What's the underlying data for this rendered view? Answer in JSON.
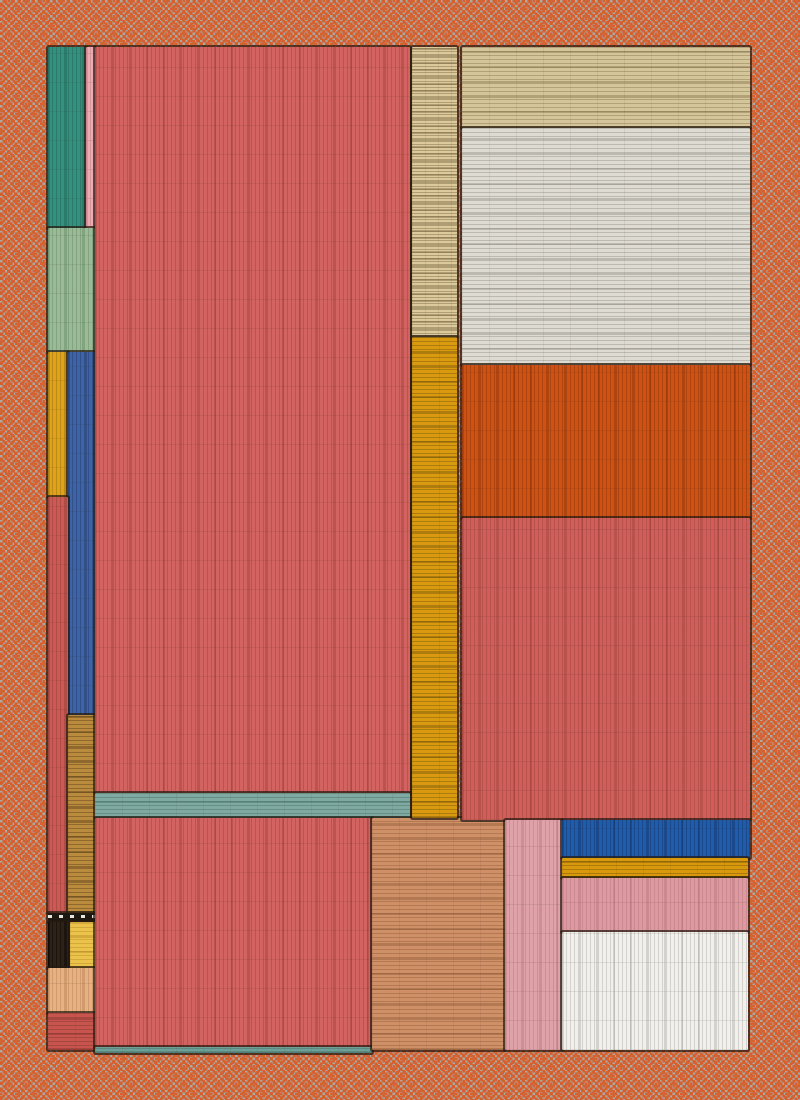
{
  "artwork": {
    "title": "abstract-hatched-color-field",
    "canvas": {
      "width": 800,
      "height": 1100
    },
    "background": {
      "pattern": "dither-checker",
      "colors": [
        "#d95f2b",
        "#a9a9a5"
      ]
    },
    "stroke_color": "#261b11",
    "pieces": [
      {
        "name": "teal-block-top-left",
        "x": 48,
        "y": 47,
        "w": 38,
        "h": 181,
        "color": "#35917f",
        "line": "#1c5a4e66",
        "hatch": "v"
      },
      {
        "name": "pink-sliver-top-left",
        "x": 86,
        "y": 47,
        "w": 9,
        "h": 181,
        "color": "#ecaab1",
        "line": "#b06a7455",
        "hatch": "v"
      },
      {
        "name": "sage-block-left",
        "x": 48,
        "y": 228,
        "w": 47,
        "h": 124,
        "color": "#9cba98",
        "line": "#4c7a4c55",
        "hatch": "v"
      },
      {
        "name": "gold-sliver-left",
        "x": 48,
        "y": 352,
        "w": 20,
        "h": 145,
        "color": "#dfa31a",
        "line": "#8a640e66",
        "hatch": "v"
      },
      {
        "name": "blue-sliver-left",
        "x": 68,
        "y": 352,
        "w": 27,
        "h": 363,
        "color": "#3e63a6",
        "line": "#1e355e66",
        "hatch": "v"
      },
      {
        "name": "red-sliver-left",
        "x": 48,
        "y": 497,
        "w": 20,
        "h": 416,
        "color": "#cc5a54",
        "line": "#7a2f2a55",
        "hatch": "v"
      },
      {
        "name": "brown-sliver-left",
        "x": 68,
        "y": 715,
        "w": 27,
        "h": 198,
        "color": "#bb8b3d",
        "line": "#5a401877",
        "hatch": "h"
      },
      {
        "name": "black-band-left",
        "x": 48,
        "y": 913,
        "w": 47,
        "h": 9,
        "color": "#1e1812",
        "line": "#e8e6df88",
        "hatch": "dashes"
      },
      {
        "name": "dark-brown-block-left",
        "x": 48,
        "y": 922,
        "w": 22,
        "h": 46,
        "color": "#2e2217",
        "line": "#00000066",
        "hatch": "v"
      },
      {
        "name": "yellow-block-left",
        "x": 70,
        "y": 922,
        "w": 25,
        "h": 46,
        "color": "#ecc34a",
        "line": "#a3762055",
        "hatch": "h"
      },
      {
        "name": "peach-block-left",
        "x": 48,
        "y": 968,
        "w": 47,
        "h": 45,
        "color": "#e7b184",
        "line": "#a5703f55",
        "hatch": "v"
      },
      {
        "name": "red-block-bottom-left",
        "x": 48,
        "y": 1013,
        "w": 47,
        "h": 37,
        "color": "#c7554e",
        "line": "#7a2f2a66",
        "hatch": "h"
      },
      {
        "name": "main-red-block",
        "x": 95,
        "y": 47,
        "w": 315,
        "h": 746,
        "color": "#d26360",
        "line": "#8c363055",
        "hatch": "v"
      },
      {
        "name": "teal-strip-middle",
        "x": 95,
        "y": 793,
        "w": 315,
        "h": 25,
        "color": "#80a9a1",
        "line": "#3d6a6266",
        "hatch": "h"
      },
      {
        "name": "bottom-red-block",
        "x": 95,
        "y": 818,
        "w": 277,
        "h": 229,
        "color": "#d26360",
        "line": "#8c363055",
        "hatch": "v"
      },
      {
        "name": "bottom-teal-line",
        "x": 95,
        "y": 1047,
        "w": 277,
        "h": 6,
        "color": "#6fa097",
        "line": "#3d6a6266",
        "hatch": "h"
      },
      {
        "name": "bottom-tan-block",
        "x": 372,
        "y": 818,
        "w": 133,
        "h": 232,
        "color": "#cf9068",
        "line": "#7a4a2855",
        "hatch": "h"
      },
      {
        "name": "tan-strip-top-middle",
        "x": 412,
        "y": 47,
        "w": 45,
        "h": 290,
        "color": "#dcca9d",
        "line": "#6b5a3466",
        "hatch": "rough"
      },
      {
        "name": "gold-strip-middle",
        "x": 412,
        "y": 337,
        "w": 45,
        "h": 481,
        "color": "#d99a10",
        "line": "#6b4c0a66",
        "hatch": "h"
      },
      {
        "name": "beige-band-top-right",
        "x": 462,
        "y": 47,
        "w": 288,
        "h": 81,
        "color": "#d5c59a",
        "line": "#6b5a3455",
        "hatch": "h"
      },
      {
        "name": "white-region-top-right",
        "x": 462,
        "y": 128,
        "w": 288,
        "h": 237,
        "color": "#dedbd3",
        "line": "#8a867e66",
        "hatch": "h"
      },
      {
        "name": "orange-region-right",
        "x": 462,
        "y": 365,
        "w": 288,
        "h": 153,
        "color": "#d05212",
        "line": "#7c300d66",
        "hatch": "v"
      },
      {
        "name": "right-red-block",
        "x": 462,
        "y": 518,
        "w": 288,
        "h": 302,
        "color": "#d05f5c",
        "line": "#8c363055",
        "hatch": "v"
      },
      {
        "name": "pink-column-bottom",
        "x": 505,
        "y": 820,
        "w": 57,
        "h": 230,
        "color": "#e0a2a9",
        "line": "#a8666f55",
        "hatch": "v"
      },
      {
        "name": "blue-band-bottom-right",
        "x": 562,
        "y": 820,
        "w": 188,
        "h": 38,
        "color": "#1f5cab",
        "line": "#122f5c66",
        "hatch": "v"
      },
      {
        "name": "gold-band-bottom-right",
        "x": 562,
        "y": 858,
        "w": 186,
        "h": 20,
        "color": "#d9990c",
        "line": "#6b4c0a66",
        "hatch": "h"
      },
      {
        "name": "pink-band-bottom-right",
        "x": 562,
        "y": 878,
        "w": 186,
        "h": 54,
        "color": "#dd9aa1",
        "line": "#a8666f55",
        "hatch": "v"
      },
      {
        "name": "white-block-bottom-right",
        "x": 562,
        "y": 932,
        "w": 186,
        "h": 118,
        "color": "#f1f0ec",
        "line": "#9a968e55",
        "hatch": "v"
      }
    ]
  }
}
